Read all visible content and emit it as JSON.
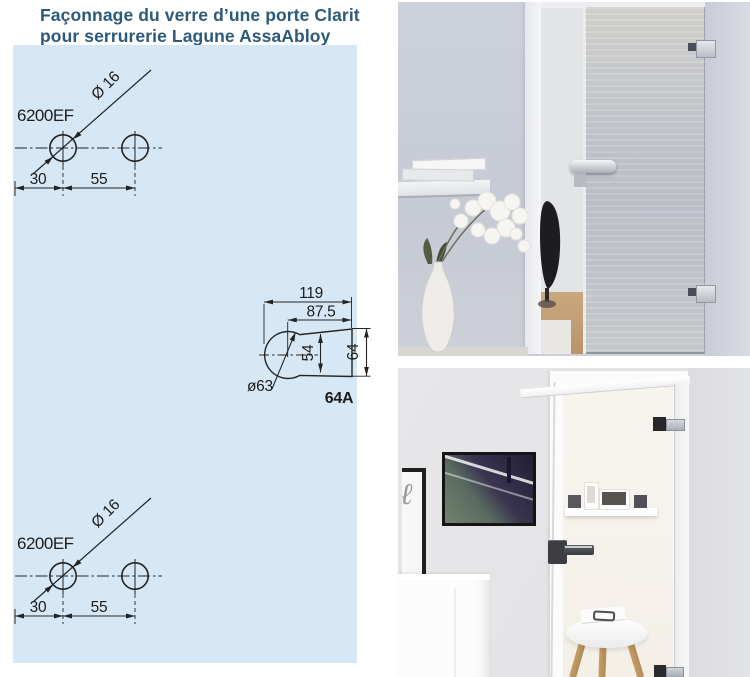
{
  "title": {
    "line1": "Façonnage du verre d’une porte Clarit",
    "line2": "pour serrurerie Lagune AssaAbloy"
  },
  "colors": {
    "panel_background": "#d6e8f6",
    "title_text": "#2d5a7a",
    "drawing_lines": "#232323"
  },
  "drawing_top": {
    "part_label": "6200EF",
    "hole_diameter": "Ø 16",
    "dim_edge_to_hole": "30",
    "dim_hole_to_hole": "55"
  },
  "drawing_bottom": {
    "part_label": "6200EF",
    "hole_diameter": "Ø 16",
    "dim_edge_to_hole": "30",
    "dim_hole_to_hole": "55"
  },
  "cutout_drawing": {
    "dim_total_width": "119",
    "dim_center_to_edge": "87.5",
    "dim_inner_height": "54",
    "dim_outer_height": "64",
    "dim_circle_diameter": "ø63",
    "part_label": "64A"
  }
}
